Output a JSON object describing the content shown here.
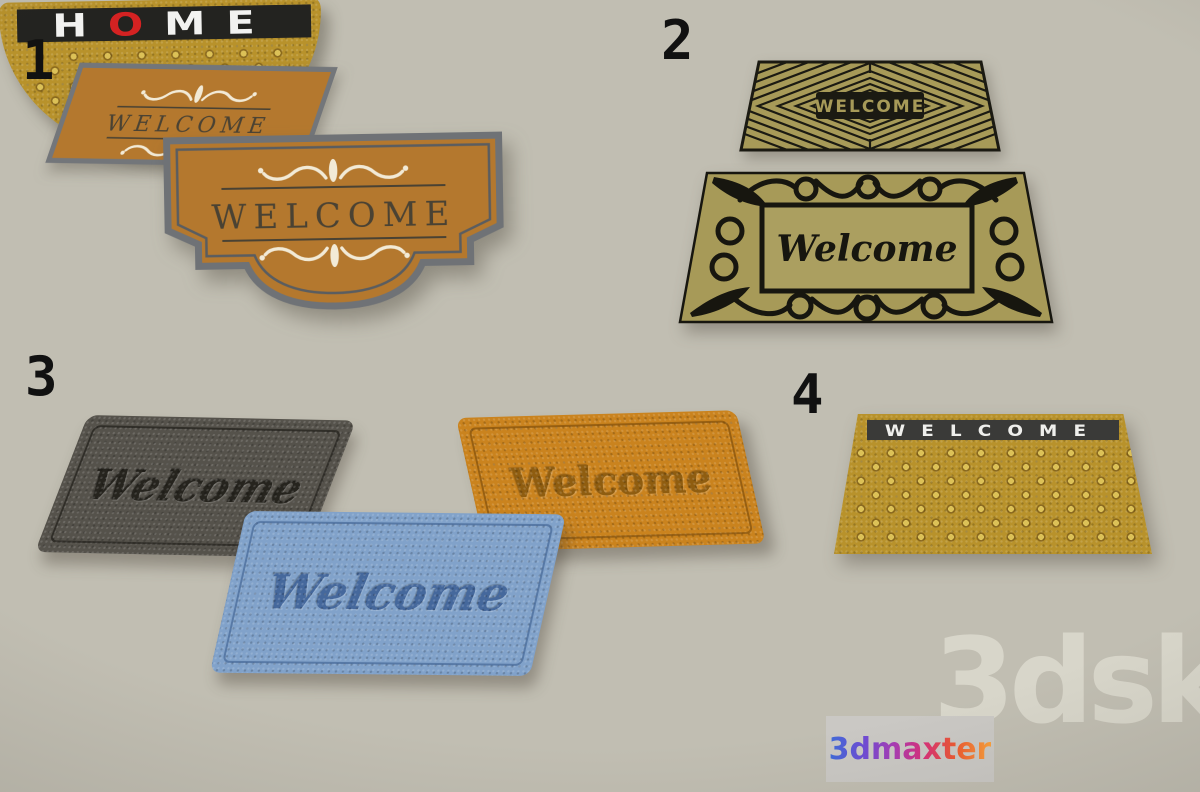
{
  "scene": {
    "type": "3d-doormat-collection-preview",
    "background_color": "#c1beb2"
  },
  "groups": {
    "g1": {
      "number": "1",
      "mat_flat": {
        "text": "WELCOME",
        "color": "#b4782e",
        "border_color": "#73767a",
        "accent": "#f2ead6"
      },
      "mat_shaped": {
        "text": "WELCOME",
        "color": "#b4782e",
        "border_color": "#6f7276",
        "accent": "#f2ead6"
      }
    },
    "g2": {
      "number": "2",
      "mat_geometric": {
        "text": "WELCOME",
        "color": "#a79a58",
        "pattern_color": "#1b1a12"
      },
      "mat_ornate": {
        "text": "Welcome",
        "color": "#a79a58",
        "pattern_color": "#17160f"
      }
    },
    "g3": {
      "number": "3",
      "mat_dark": {
        "text": "Welcome",
        "color": "#55524b"
      },
      "mat_orange": {
        "text": "Welcome",
        "color": "#ca831e"
      },
      "mat_blue": {
        "text": "Welcome",
        "color": "#81a2ca"
      }
    },
    "g4": {
      "number": "4",
      "mat_dotted": {
        "text": "WELCOME",
        "color": "#b8922b",
        "banner_color": "#3a3a38"
      },
      "mat_half_round": {
        "text_h": "H",
        "text_o": "O",
        "text_me": "ME",
        "color": "#b8922b",
        "banner_color": "#232320",
        "o_color": "#d42222"
      }
    }
  },
  "watermarks": {
    "logo_text": "3dmaxter",
    "site_text": "3dsky"
  }
}
